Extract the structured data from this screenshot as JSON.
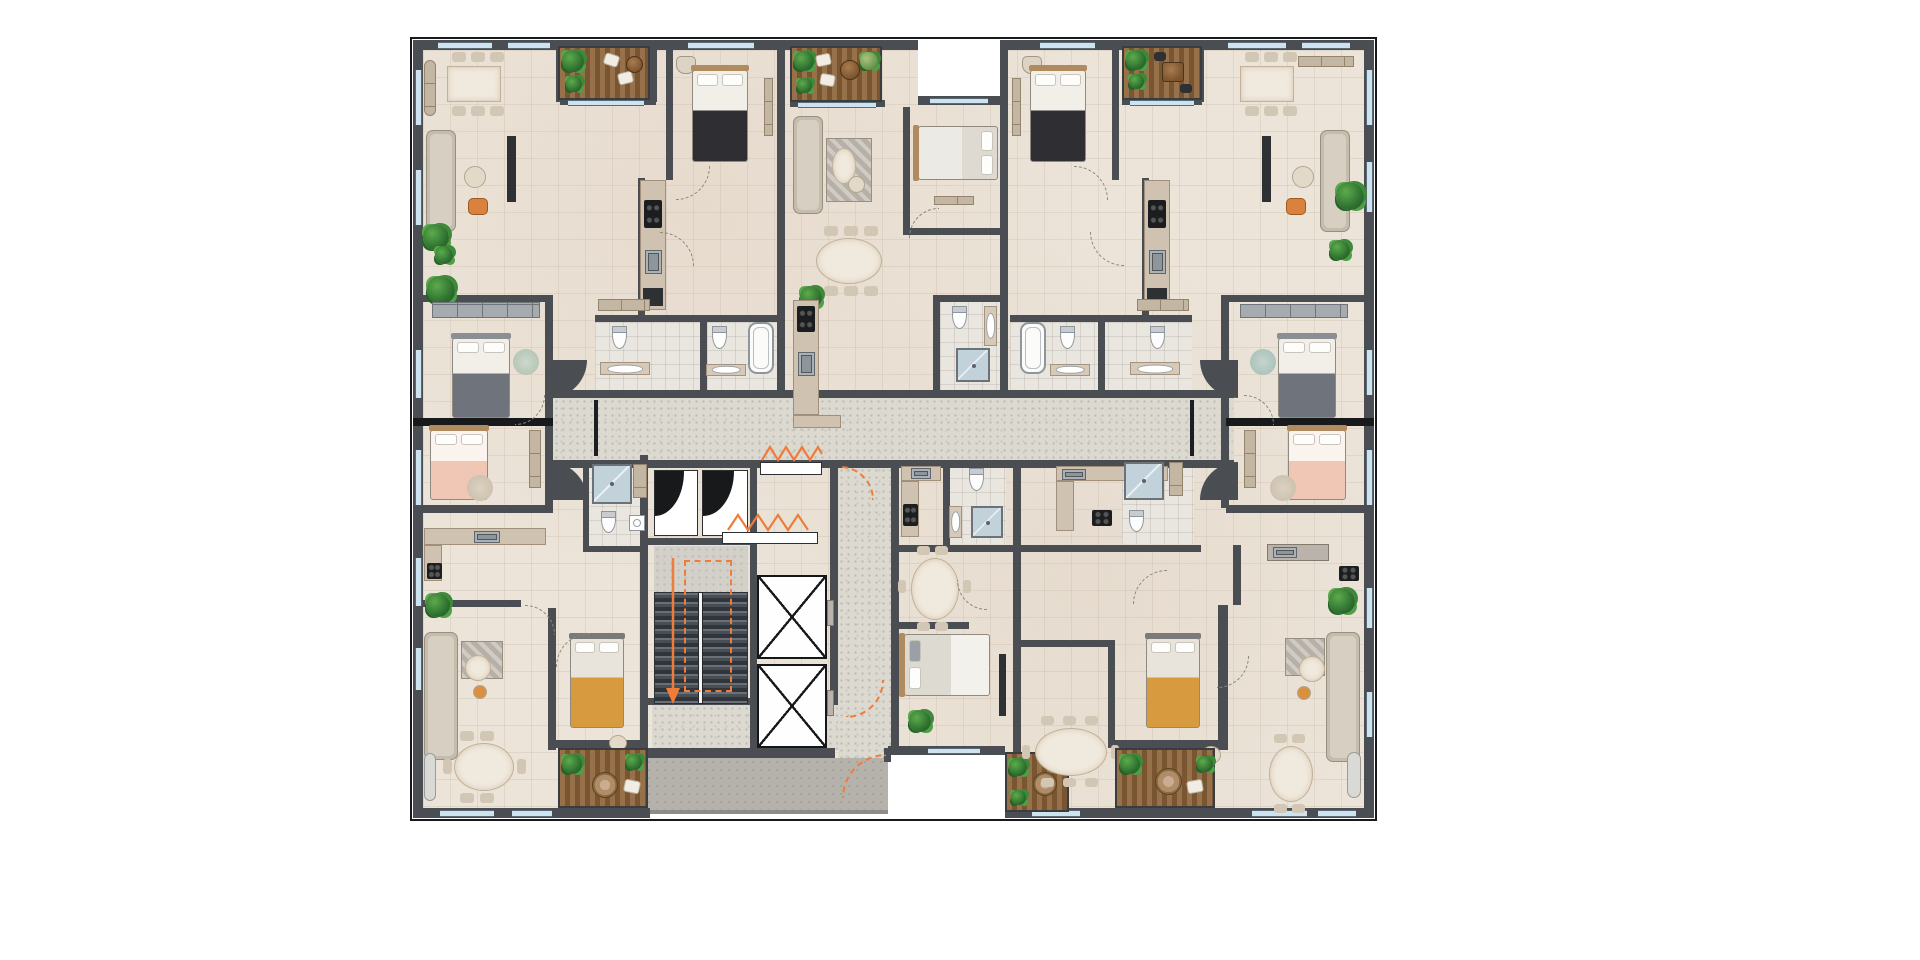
{
  "meta": {
    "title": "Residential floor plan — furnished color site plan, top-down view",
    "type": "architectural-floor-plan",
    "text_content": "none (drawing contains no legible text or dimensions)"
  },
  "palette": {
    "page": "#ffffff",
    "wall": "#4a4e52",
    "wallDark": "#17191b",
    "floor": "#ece4d9",
    "corridor": "#dcd9d1",
    "speck": "#bdbab1",
    "window": "#cde4f0",
    "winline": "#5a6a74",
    "deckA": "#96714a",
    "deckB": "#7a5531",
    "deckEdge": "#3a3d40",
    "plant1": "#2e7030",
    "plant3": "#1d5322",
    "sofa": "#c6bcae",
    "sofaIn": "#d8d0c3",
    "sline": "#97907f",
    "marble": "#f0e9dd",
    "counter": "#cfc2b0",
    "cline": "#a08f7a",
    "closet": "#a6abaf",
    "dark": "#2e3134",
    "fixture": "#fdfdfd",
    "fixline": "#8f969b",
    "showerBg": "#c2d2da",
    "orange": "#ef7d3a",
    "orangeChair": "#d9813d",
    "throwDark": "#2f2e33",
    "throwGray": "#6f747c",
    "throwYellow": "#d89a3e",
    "pink": "#f0c7b4"
  },
  "core": {
    "stairs": {
      "flights": 2,
      "escape_route_marking": "orange dashed loop with down arrow"
    },
    "elevators": 2,
    "vent_shafts": 2,
    "smoke_vent_symbols": "orange zigzag glyphs",
    "entrance": "bottom-centre walkway with orange door swing"
  },
  "circulation": {
    "corridor": "central horizontal hallway with curved keyhole ends",
    "lobby": "below elevators, links to entrance walkway"
  },
  "units": [
    {
      "label": "top-left apartment",
      "rooms": [
        "living-dining",
        "terrace-deck",
        "bedroom",
        "kitchen",
        "two bathrooms"
      ],
      "furniture": [
        "6-seat dining table",
        "L-sofa",
        "coffee table",
        "orange armchair",
        "TV console",
        "double bed dark throw",
        "wardrobe",
        "bathtub",
        "toilets",
        "vanities",
        "plants"
      ]
    },
    {
      "label": "top-centre apartment",
      "rooms": [
        "terrace-deck",
        "living",
        "bedroom",
        "dining",
        "kitchen",
        "bathroom"
      ],
      "furniture": [
        "sofa with rug",
        "oval coffee table",
        "white double bed",
        "6-seat oval dining",
        "shower",
        "toilet",
        "plants"
      ]
    },
    {
      "label": "top-right apartment",
      "rooms": [
        "bedroom",
        "terrace-deck",
        "living-dining",
        "kitchen",
        "two bathrooms"
      ],
      "furniture": [
        "double bed dark throw",
        "deck table with two chairs",
        "6-seat dining table",
        "L-sofa",
        "orange armchair",
        "bathtub",
        "plants"
      ]
    },
    {
      "label": "mid-left bedrooms",
      "rooms": [
        "grey-throw bedroom",
        "pink bedroom"
      ],
      "furniture": [
        "wardrobe",
        "grey bed",
        "pink bed",
        "round rugs",
        "bench"
      ]
    },
    {
      "label": "mid-right bedrooms",
      "rooms": [
        "grey-throw bedroom",
        "pink bedroom"
      ],
      "furniture": [
        "wardrobe",
        "grey bed",
        "pink bed",
        "round rugs",
        "bench"
      ]
    },
    {
      "label": "bottom-left apartment",
      "rooms": [
        "kitchen",
        "living",
        "dining",
        "bedroom",
        "bathroom",
        "terrace-deck"
      ],
      "furniture": [
        "counter with sink and hob",
        "L-sofa",
        "round coffee table",
        "6-seat oval dining",
        "yellow-throw bed",
        "shower",
        "deck with parasol table",
        "plants"
      ]
    },
    {
      "label": "bottom-centre apartment",
      "rooms": [
        "kitchen",
        "bathroom",
        "dining",
        "bedroom",
        "terrace-deck"
      ],
      "furniture": [
        "6-seat oval dining",
        "white bed grey pillows",
        "shower",
        "toilet",
        "plants"
      ]
    },
    {
      "label": "bottom-right apartment",
      "rooms": [
        "kitchen",
        "dining-8",
        "yellow bedroom",
        "terrace-deck",
        "living",
        "oval dining"
      ],
      "furniture": [
        "8-seat oval dining",
        "yellow-throw bed",
        "parasol deck",
        "L-sofa",
        "round marble table",
        "orange pouf",
        "6-seat oval dining",
        "window benches",
        "plants"
      ]
    }
  ],
  "terraces": {
    "count": 6,
    "finish": "timber deck boards with planters and round tables"
  },
  "markings": {
    "door_swings": "grey dashed quarter arcs",
    "escape": "orange dashed arcs, arrows and zigzag vent glyphs"
  }
}
